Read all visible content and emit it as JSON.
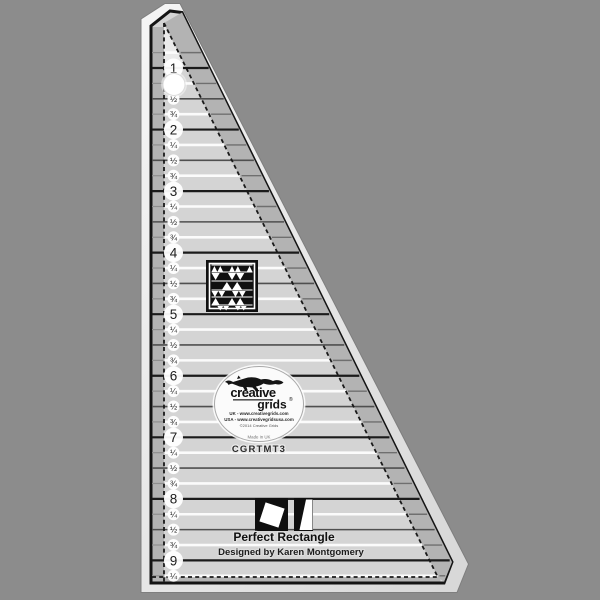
{
  "scene": {
    "background_color": "#8c8c8c"
  },
  "ruler": {
    "product_code": "CGRTMT3",
    "inch_labels": [
      "1",
      "2",
      "3",
      "4",
      "5",
      "6",
      "7",
      "8",
      "9"
    ],
    "fraction_labels": {
      "0.25": "¼",
      "0.5": "½",
      "0.75": "¾"
    },
    "colors": {
      "body": "#d4d4d4",
      "edge_light": "#f4f4f4",
      "edge_dark": "#d9d9d9",
      "band": "#b3b3b3",
      "border": "#141414",
      "inch_line": "#1b1b1b",
      "half_line": "#4f4f4f",
      "quarter_line": "#fbfbfb",
      "stub_line": "#6f6f6f",
      "label_text": "#1d1d1d",
      "halo": "#ffffff"
    }
  },
  "logo": {
    "brand_line1": "creative",
    "brand_line2": "grids",
    "registered_mark": "®",
    "url_uk": "UK - www.creativegrids.com",
    "url_usa": "USA - www.creativegridsusa.com",
    "copyright": "©2014 Creative Grids",
    "origin": "Made in UK"
  },
  "footer": {
    "title": "Perfect Rectangle",
    "subtitle": "Designed by Karen Montgomery"
  }
}
